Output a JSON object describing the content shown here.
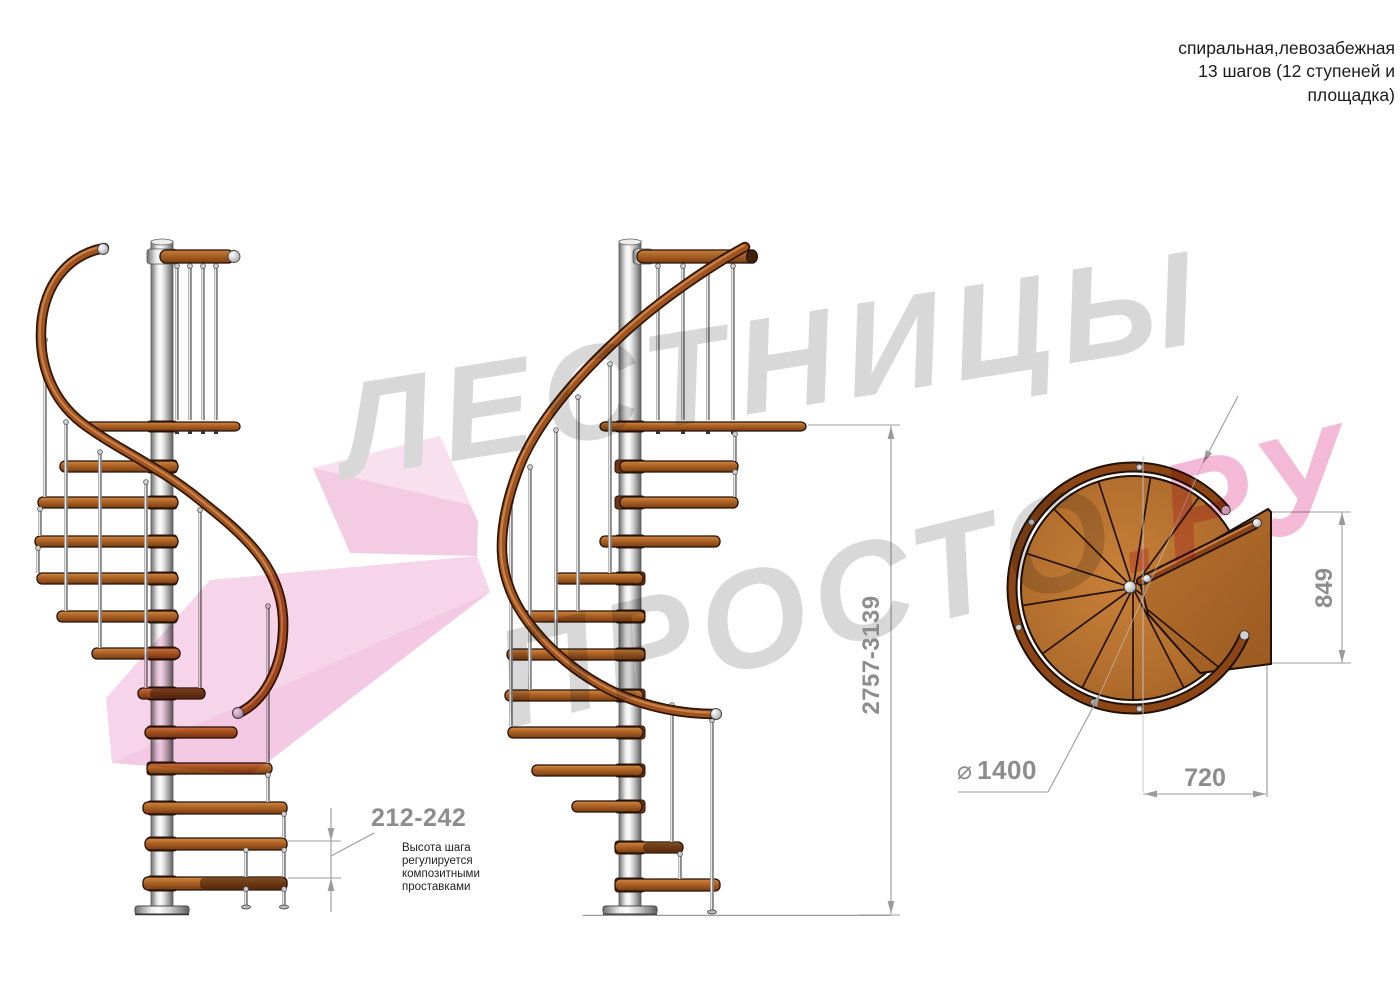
{
  "title": {
    "line1": "спиральная,левозабежная",
    "line2": "13 шагов (12 ступеней и",
    "line3": "площадка)"
  },
  "watermark": {
    "word1": "ЛЕСТНИЦЫ",
    "word2": "ПРОСТО",
    "word2_suffix": ".РУ"
  },
  "dimensions": {
    "step_height": "212-242",
    "total_height": "2757-3139",
    "platform_depth": "849",
    "platform_width": "720",
    "diameter_symbol": "⌀",
    "diameter_value": "1400"
  },
  "note": {
    "line1": "Высота шага",
    "line2": "регулируется",
    "line3": "композитными",
    "line4": "проставками"
  },
  "stair_info": {
    "type": "спиральная,левозабежная",
    "steps_total": 13,
    "treads": 12,
    "has_platform": true
  },
  "colors": {
    "wood": "#b4702c",
    "handrail_dark": "#8c4515",
    "metal": "#c9c9c9",
    "dimension_gray": "#8d8d8d",
    "watermark_gray": "#d8d8d8",
    "watermark_pink": "#f4b9d6",
    "arrow_pink": "#f6d4e9"
  }
}
